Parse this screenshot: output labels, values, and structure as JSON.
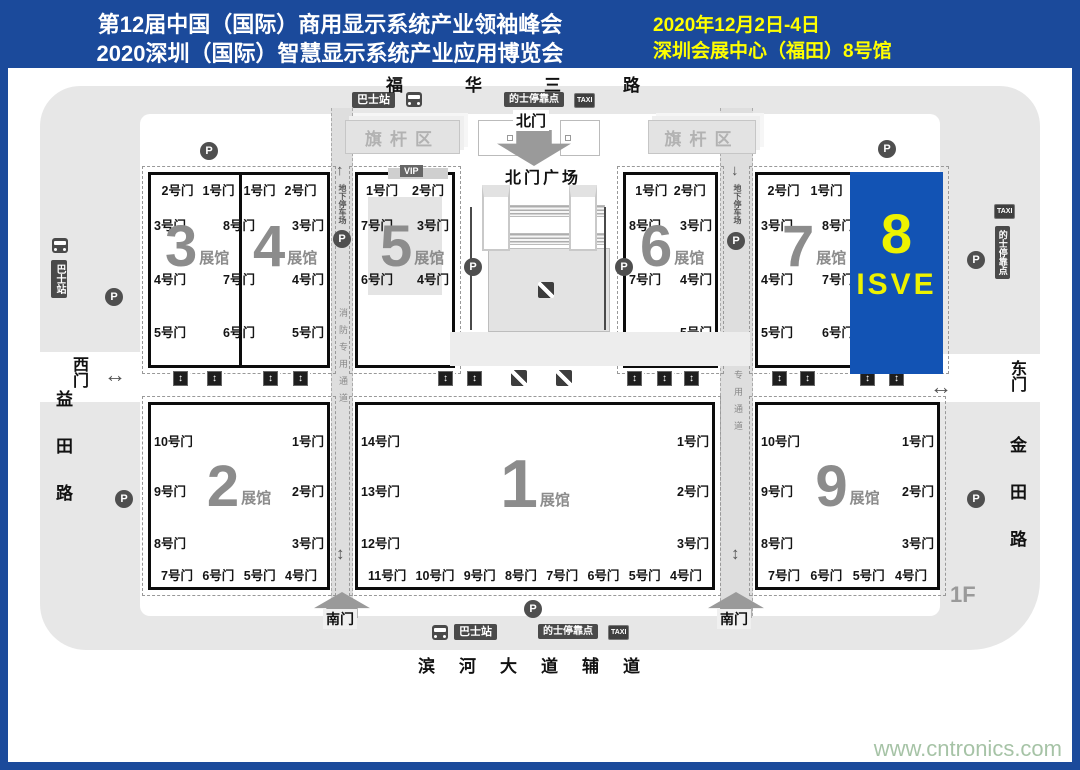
{
  "header": {
    "title_line1": "第12届中国（国际）商用显示系统产业领袖峰会",
    "title_line2": "2020深圳（国际）智慧显示系统产业应用博览会",
    "date": "2020年12月2日-4日",
    "venue": "深圳会展中心（福田）8号馆"
  },
  "streets": {
    "north": "福华三路",
    "south": "滨河大道辅道",
    "west": "益田路",
    "east": "金田路"
  },
  "entrances": {
    "north": "北门",
    "north_plaza": "北门广场",
    "south": "南门",
    "west": "西门",
    "east": "东门"
  },
  "badges": {
    "flag_area": "旗杆区",
    "bus": "巴士站",
    "taxi_stop": "的士停靠点",
    "taxi": "TAXI",
    "vip": "VIP",
    "parking": "P",
    "underground_parking": "地下停车场",
    "fire_lane": "消防专用通道",
    "floor": "1F"
  },
  "icons": {
    "up": "↑",
    "down": "↓",
    "updown": "↕",
    "leftright": "↔"
  },
  "halls": {
    "h1": {
      "num": "1",
      "suffix": "展馆"
    },
    "h2": {
      "num": "2",
      "suffix": "展馆"
    },
    "h3": {
      "num": "3",
      "suffix": "展馆"
    },
    "h4": {
      "num": "4",
      "suffix": "展馆"
    },
    "h5": {
      "num": "5",
      "suffix": "展馆"
    },
    "h6": {
      "num": "6",
      "suffix": "展馆"
    },
    "h7": {
      "num": "7",
      "suffix": "展馆"
    },
    "h8": {
      "num": "8",
      "label": "ISVE"
    },
    "h9": {
      "num": "9",
      "suffix": "展馆"
    }
  },
  "gates": {
    "block34": {
      "top": [
        "2号门",
        "1号门",
        "1号门",
        "2号门"
      ],
      "left": [
        "3号门",
        "4号门",
        "5号门"
      ],
      "mid": [
        "8号门",
        "7号门",
        "6号门"
      ],
      "right": [
        "3号门",
        "4号门",
        "5号门"
      ]
    },
    "hall5": {
      "top": [
        "1号门",
        "2号门"
      ],
      "left": [
        "7号门",
        "6号门"
      ],
      "right": [
        "3号门",
        "4号门"
      ]
    },
    "hall6": {
      "top": [
        "1号门",
        "2号门"
      ],
      "left": [
        "8号门",
        "7号门"
      ],
      "right": [
        "3号门",
        "4号门",
        "5号门"
      ]
    },
    "block78": {
      "top": [
        "2号门",
        "1号门"
      ],
      "left": [
        "3号门",
        "4号门",
        "5号门"
      ],
      "mid": [
        "8号门",
        "7号门",
        "6号门"
      ]
    },
    "hall2": {
      "left": [
        "10号门",
        "9号门",
        "8号门"
      ],
      "right": [
        "1号门",
        "2号门",
        "3号门"
      ],
      "bottom": [
        "7号门",
        "6号门",
        "5号门",
        "4号门"
      ]
    },
    "hall1": {
      "left": [
        "14号门",
        "13号门",
        "12号门"
      ],
      "right": [
        "1号门",
        "2号门",
        "3号门"
      ],
      "bottom": [
        "11号门",
        "10号门",
        "9号门",
        "8号门",
        "7号门",
        "6号门",
        "5号门",
        "4号门"
      ]
    },
    "hall9": {
      "left": [
        "10号门",
        "9号门",
        "8号门"
      ],
      "right": [
        "1号门",
        "2号门",
        "3号门"
      ],
      "bottom": [
        "7号门",
        "6号门",
        "5号门",
        "4号门"
      ]
    }
  },
  "colors": {
    "frame_blue": "#1b4a9b",
    "hall8_blue": "#1253b4",
    "header_yellow": "#ffff00",
    "hall8_yellow": "#edf200",
    "road_gray": "#e7e7e7",
    "hall_number_gray": "#8c8c8c"
  },
  "watermark": "www.cntronics.com"
}
